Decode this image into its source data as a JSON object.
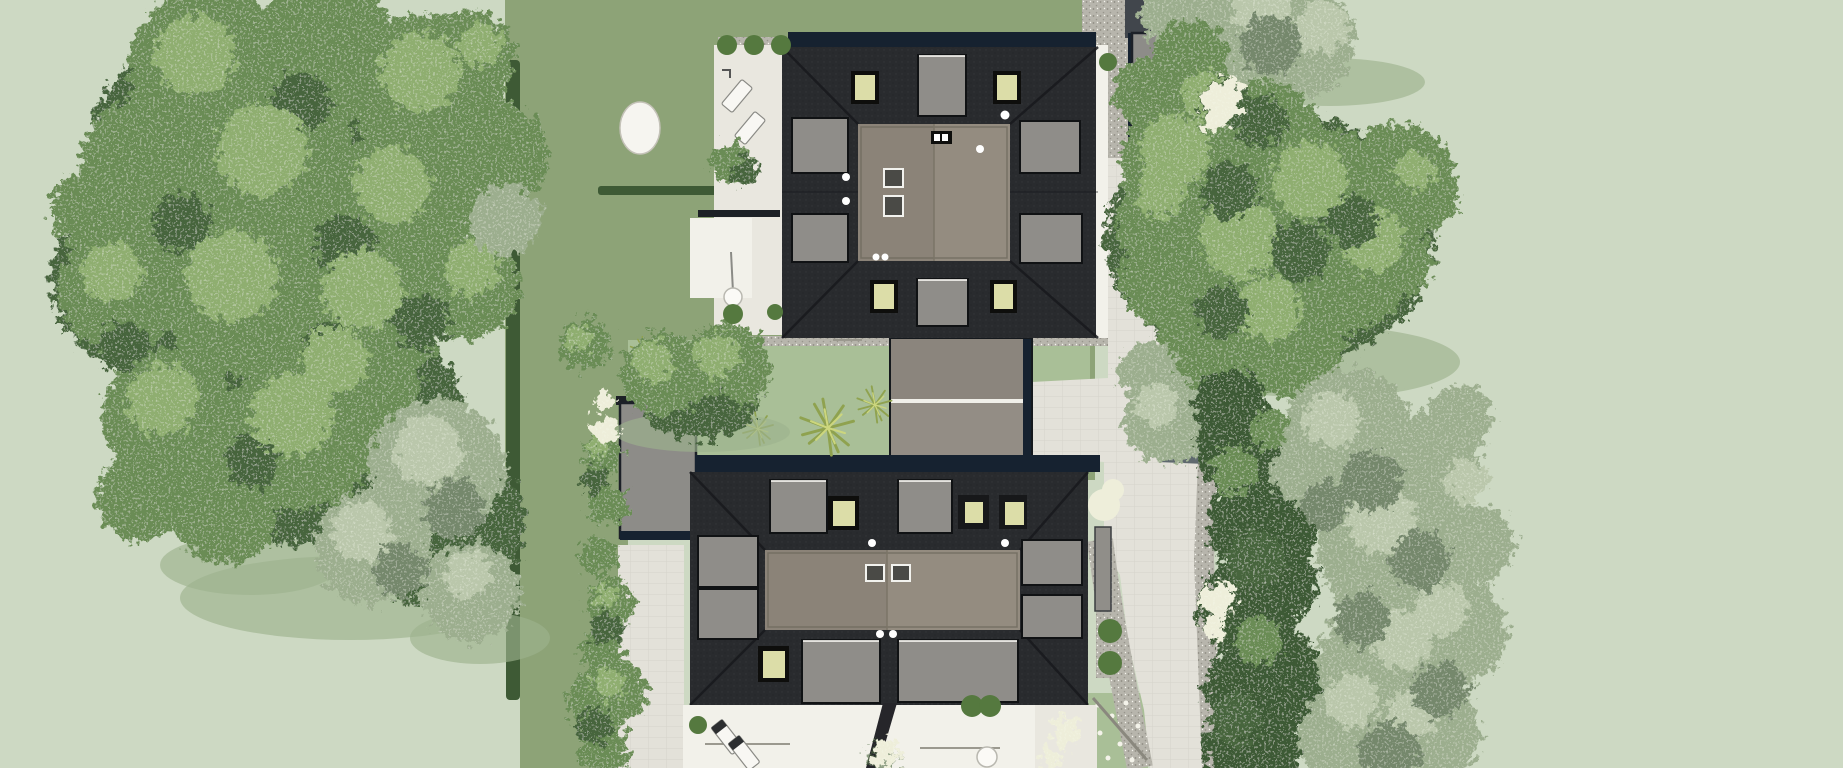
{
  "meta": {
    "title": "Aerial site plan rendering - two houses with rooftop terraces and gardens",
    "view": "top-down architectural visualization",
    "canvas": {
      "width": 1843,
      "height": 768
    }
  },
  "palette": {
    "bg_pale": "#cdd9c3",
    "lawn_medium": "#8da377",
    "lawn_light": "#a9bf97",
    "hedge_dark": "#3e5a35",
    "gravel": "#b7b5ac",
    "asphalt": "#41464c",
    "paver": "#e3e1d9",
    "terrace_white": "#f2f1ea",
    "garage_gray": "#8d8c88",
    "roof_navy": "#162230",
    "roof_dark": "#292b2e",
    "roof_flat": "#8b8378",
    "roof_flat_light": "#948c80",
    "dormer_gray": "#8f8d89",
    "skylight": "#dcdda8",
    "tree_green": "#6a8c55",
    "tree_green_light": "#8fae70",
    "tree_green_dark": "#47653c",
    "tree_gray": "#9cae8e",
    "tree_gray_light": "#bac7ab",
    "tree_gray_dark": "#75886c",
    "tree_shadow": "#9db28e",
    "shadow_navy": "#3d4b53",
    "white_flowers": "#eeeeda",
    "grass": "#8fa24f",
    "bush_green": "#55793f"
  },
  "scene": {
    "north_house": {
      "label": "north house",
      "roof": "dark hip roof with taupe flat rooftop terrace",
      "dormers": 6,
      "skylights": 4,
      "roof_vents": 3,
      "chimney_dots": 6
    },
    "south_house": {
      "label": "south house (semi-detached pair)",
      "roof": "dark hip roof with taupe flat rooftop terrace",
      "dormers": 8,
      "skylights": 4,
      "roof_vents": 2,
      "chimney_dots": 6
    },
    "garages": [
      {
        "label": "northeast street garage"
      },
      {
        "label": "central double garage"
      },
      {
        "label": "west garage"
      }
    ],
    "landscape": {
      "large_tree_clusters": 3,
      "hedge_rows": 2,
      "round_bushes": 12,
      "flower_shrubs": 6,
      "grass_tufts": 4,
      "lawn": "medium-green private gardens inside pale sage surroundings"
    },
    "hardscape": {
      "paths": "light paver walkway and drive along the east side with gravel borders",
      "terraces": "white patios west of north house and south of south house",
      "loungers": 4,
      "parasol_tables": 2
    }
  }
}
